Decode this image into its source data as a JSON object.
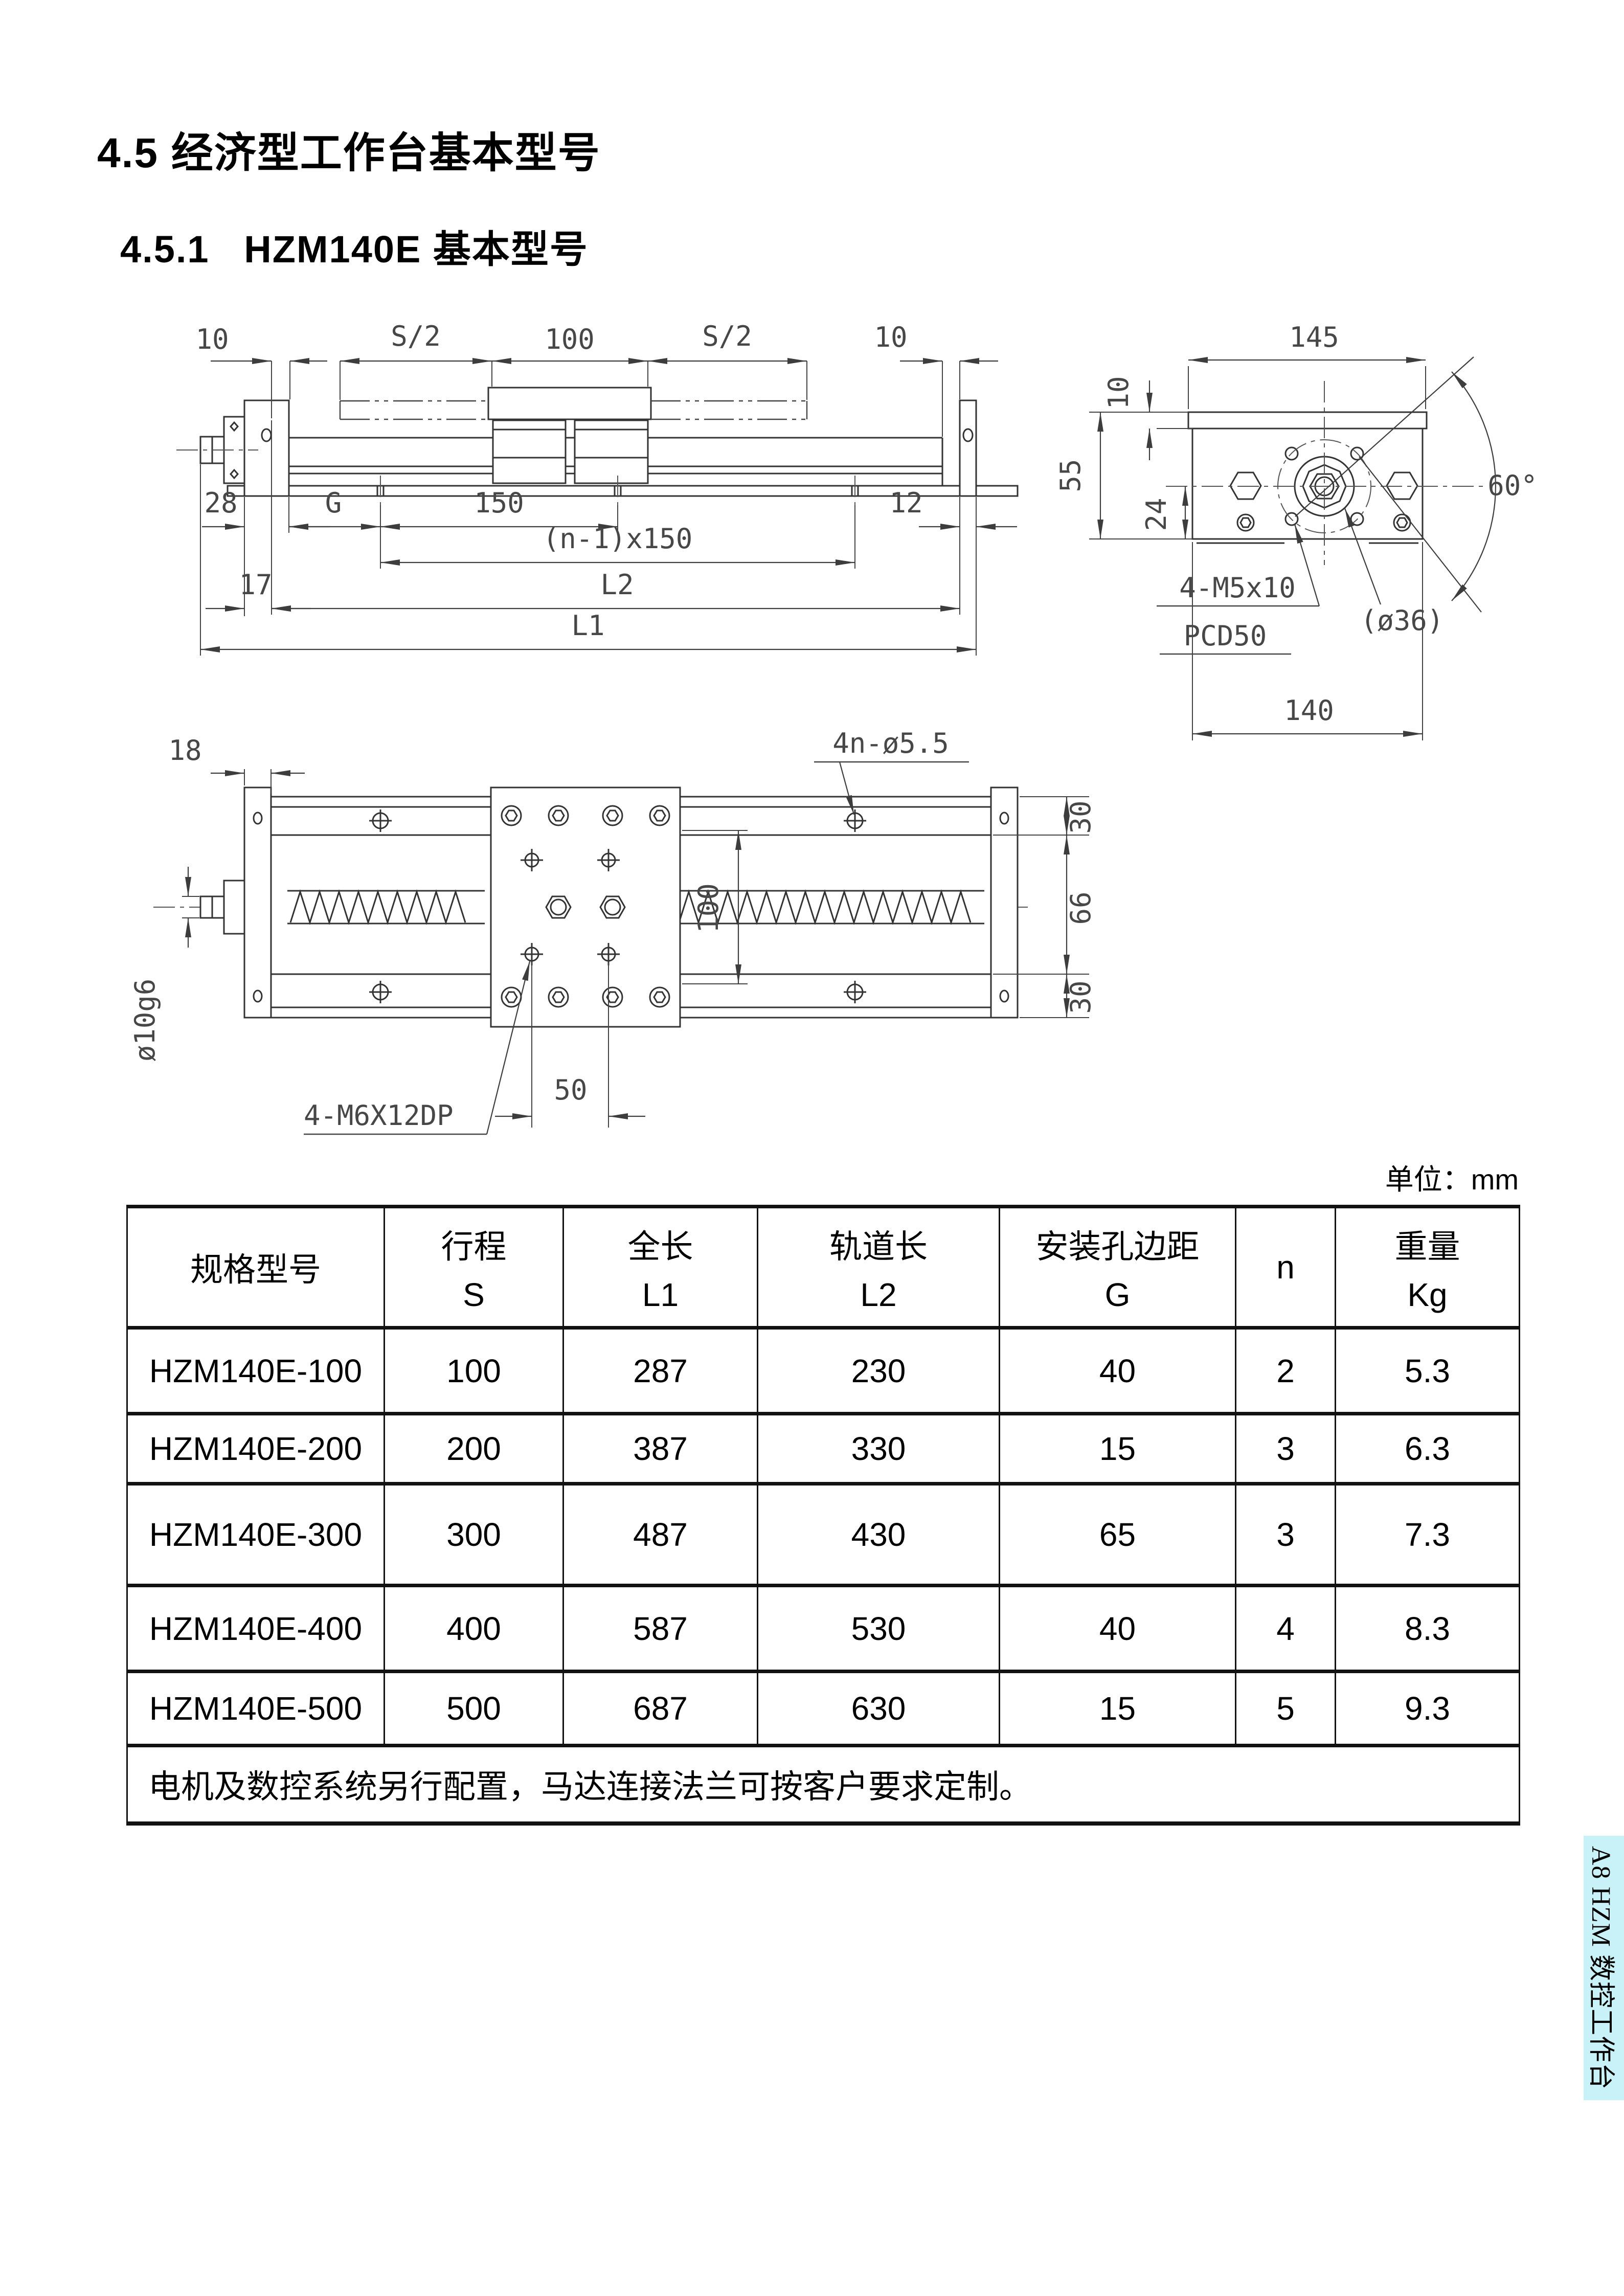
{
  "page": {
    "heading1": "4.5 经济型工作台基本型号",
    "heading2": "4.5.1   HZM140E 基本型号",
    "unit_label": "单位：mm",
    "side_tab": "A8 HZM 数控工作台",
    "colors": {
      "tab_bg": "#c8f2f8",
      "line": "#333333",
      "dim_text": "#474747"
    }
  },
  "drawings": {
    "front_view": {
      "d10l": "10",
      "dS2l": "S/2",
      "d100": "100",
      "dS2r": "S/2",
      "d10r": "10",
      "d28": "28",
      "dG": "G",
      "d150": "150",
      "d12": "12",
      "dn150": "(n-1)x150",
      "d17": "17",
      "dL2": "L2",
      "dL1": "L1"
    },
    "end_view": {
      "d10": "10",
      "d145": "145",
      "d55": "55",
      "d24": "24",
      "d60": "60°",
      "d140": "140",
      "c1": "4-M5x10",
      "c2": "PCD50",
      "c3": "(ø36)"
    },
    "plan_view": {
      "d18": "18",
      "dholes": "4n-ø5.5",
      "d30t": "30",
      "d66": "66",
      "d30b": "30",
      "d100": "100",
      "d50": "50",
      "dshaft": "ø10g6",
      "c1": "4-M6X12DP"
    }
  },
  "table": {
    "columns": [
      {
        "label": "规格型号",
        "symbol": ""
      },
      {
        "label": "行程",
        "symbol": "S"
      },
      {
        "label": "全长",
        "symbol": "L1"
      },
      {
        "label": "轨道长",
        "symbol": "L2"
      },
      {
        "label": "安装孔边距",
        "symbol": "G"
      },
      {
        "label": "n",
        "symbol": ""
      },
      {
        "label": "重量",
        "symbol": "Kg"
      }
    ],
    "rows": [
      [
        "HZM140E-100",
        "100",
        "287",
        "230",
        "40",
        "2",
        "5.3"
      ],
      [
        "HZM140E-200",
        "200",
        "387",
        "330",
        "15",
        "3",
        "6.3"
      ],
      [
        "HZM140E-300",
        "300",
        "487",
        "430",
        "65",
        "3",
        "7.3"
      ],
      [
        "HZM140E-400",
        "400",
        "587",
        "530",
        "40",
        "4",
        "8.3"
      ],
      [
        "HZM140E-500",
        "500",
        "687",
        "630",
        "15",
        "5",
        "9.3"
      ]
    ],
    "note": "电机及数控系统另行配置，马达连接法兰可按客户要求定制。"
  }
}
